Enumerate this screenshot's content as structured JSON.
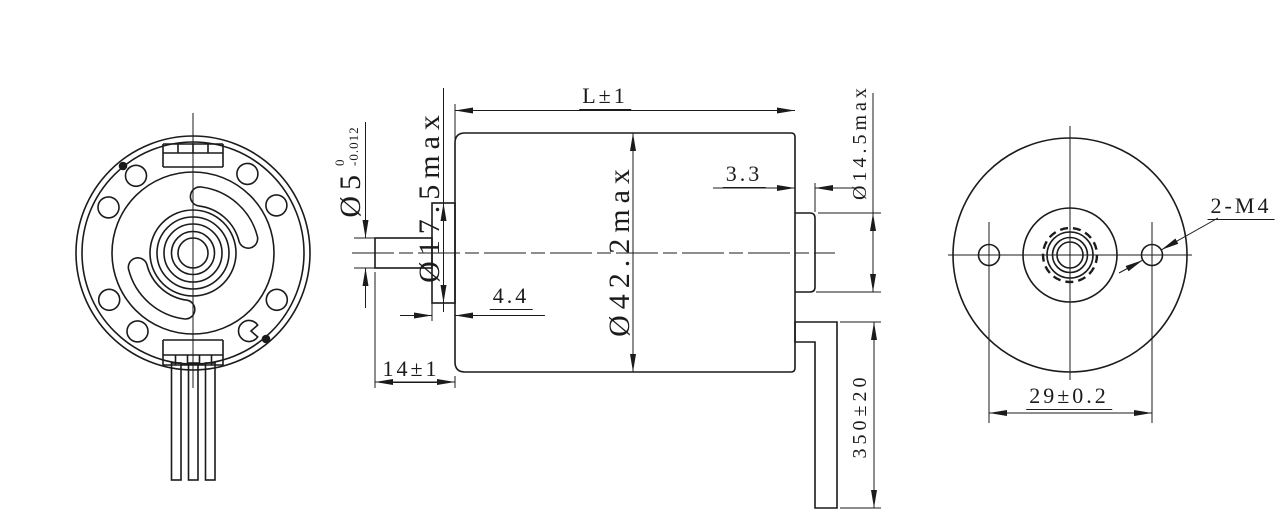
{
  "drawing": {
    "type": "motor-outline-drawing",
    "views": {
      "front_view": "front-face-with-mounting-holes",
      "side_view": "motor-body-side-profile",
      "rear_view": "rear-face-with-threaded-holes"
    },
    "dimensions": {
      "overall_length": "L±1",
      "body_diameter": "Ø42.2max",
      "flange_diameter": "Ø17.5max",
      "flange_thickness": "4.4",
      "shaft_diameter": "Ø5",
      "shaft_tolerance_upper": "0",
      "shaft_tolerance_lower": "-0.012",
      "shaft_extension": "14±1",
      "rear_boss_length": "3.3",
      "rear_boss_diameter": "Ø14.5max",
      "lead_wire_length": "350±20",
      "mounting_thread_callout": "2-M4",
      "mounting_hole_spacing": "29±0.2"
    },
    "line_color": "#1b1b1b",
    "background_color": "#ffffff"
  }
}
